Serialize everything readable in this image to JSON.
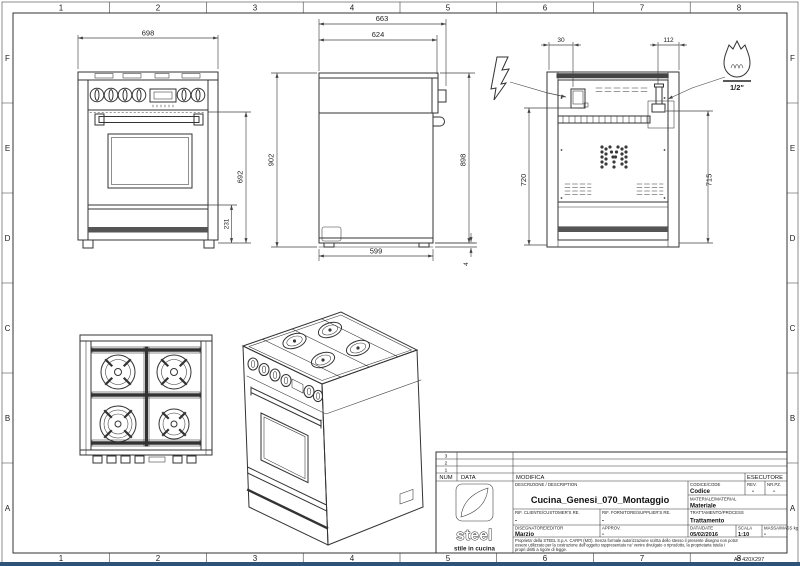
{
  "frame": {
    "cols": [
      "1",
      "2",
      "3",
      "4",
      "5",
      "6",
      "7",
      "8"
    ],
    "rows": [
      "F",
      "E",
      "D",
      "C",
      "B",
      "A"
    ],
    "sheet_code": "A3 420X297"
  },
  "views": {
    "front": {
      "dim_width": "698",
      "dim_height": "692",
      "dim_plinth": "231"
    },
    "side": {
      "dim_depth_total": "663",
      "dim_depth_top": "624",
      "dim_height_total": "902",
      "dim_height_body": "898",
      "dim_depth_base": "599",
      "dim_foot_gap": "4"
    },
    "back": {
      "dim_elec_offset": "30",
      "dim_gas_offset": "112",
      "dim_elec_height": "720",
      "dim_gas_height": "715",
      "gas_size": "1/2\""
    }
  },
  "title_block": {
    "revision_rows": [
      "3",
      "2",
      "1"
    ],
    "header": {
      "num": "NUM",
      "data": "DATA",
      "modifica": "MODIFICA",
      "esecutore": "ESECUTORE"
    },
    "description_label": "DESCRIZIONE / DESCRIPTION",
    "description": "Cucina_Genesi_070_Montaggio",
    "codice_label": "CODICE/CODE",
    "codice": "Codice",
    "rev_label": "REV.",
    "rev": "-",
    "nrpz_label": "NR.PZ.",
    "nrpz": "-",
    "materiale_label": "MATERIALE/MATERIAL",
    "materiale": "Materiale",
    "rif_cliente_label": "RIF. CLIENTE/CUSTOMER'S RE.",
    "rif_cliente": "-",
    "rif_fornitore_label": "RIF. FORNITORE/SUPPLIER'S RE.",
    "rif_fornitore": "-",
    "trattamento_label": "TRATTAMENTO/PROCESS",
    "trattamento": "Trattamento",
    "disegnatore_label": "DISEGNATORE/EDITOR",
    "disegnatore": "Marzio",
    "approv_label": "APPROV.",
    "approv": "-",
    "data_label": "DATA/DATE",
    "data_value": "05/02/2016",
    "scala_label": "SCALA",
    "scala": "1:10",
    "massa_label": "MASSA/MASS kg",
    "massa": "-",
    "logo_text": "steel",
    "logo_tagline": "stile in cucina",
    "legal_lines": [
      "Proprieta' della STEEL S.p.A. CARPI (MO). Senza formale autorizzazione scritta dello stesso il presente disegno non potra'",
      "essere utilizzato per la costruzione dell'oggetto rappresentato ne' venire divulgato o riprodotto, la proprietaria tutela i",
      "propri diritti a rigore di legge."
    ]
  }
}
